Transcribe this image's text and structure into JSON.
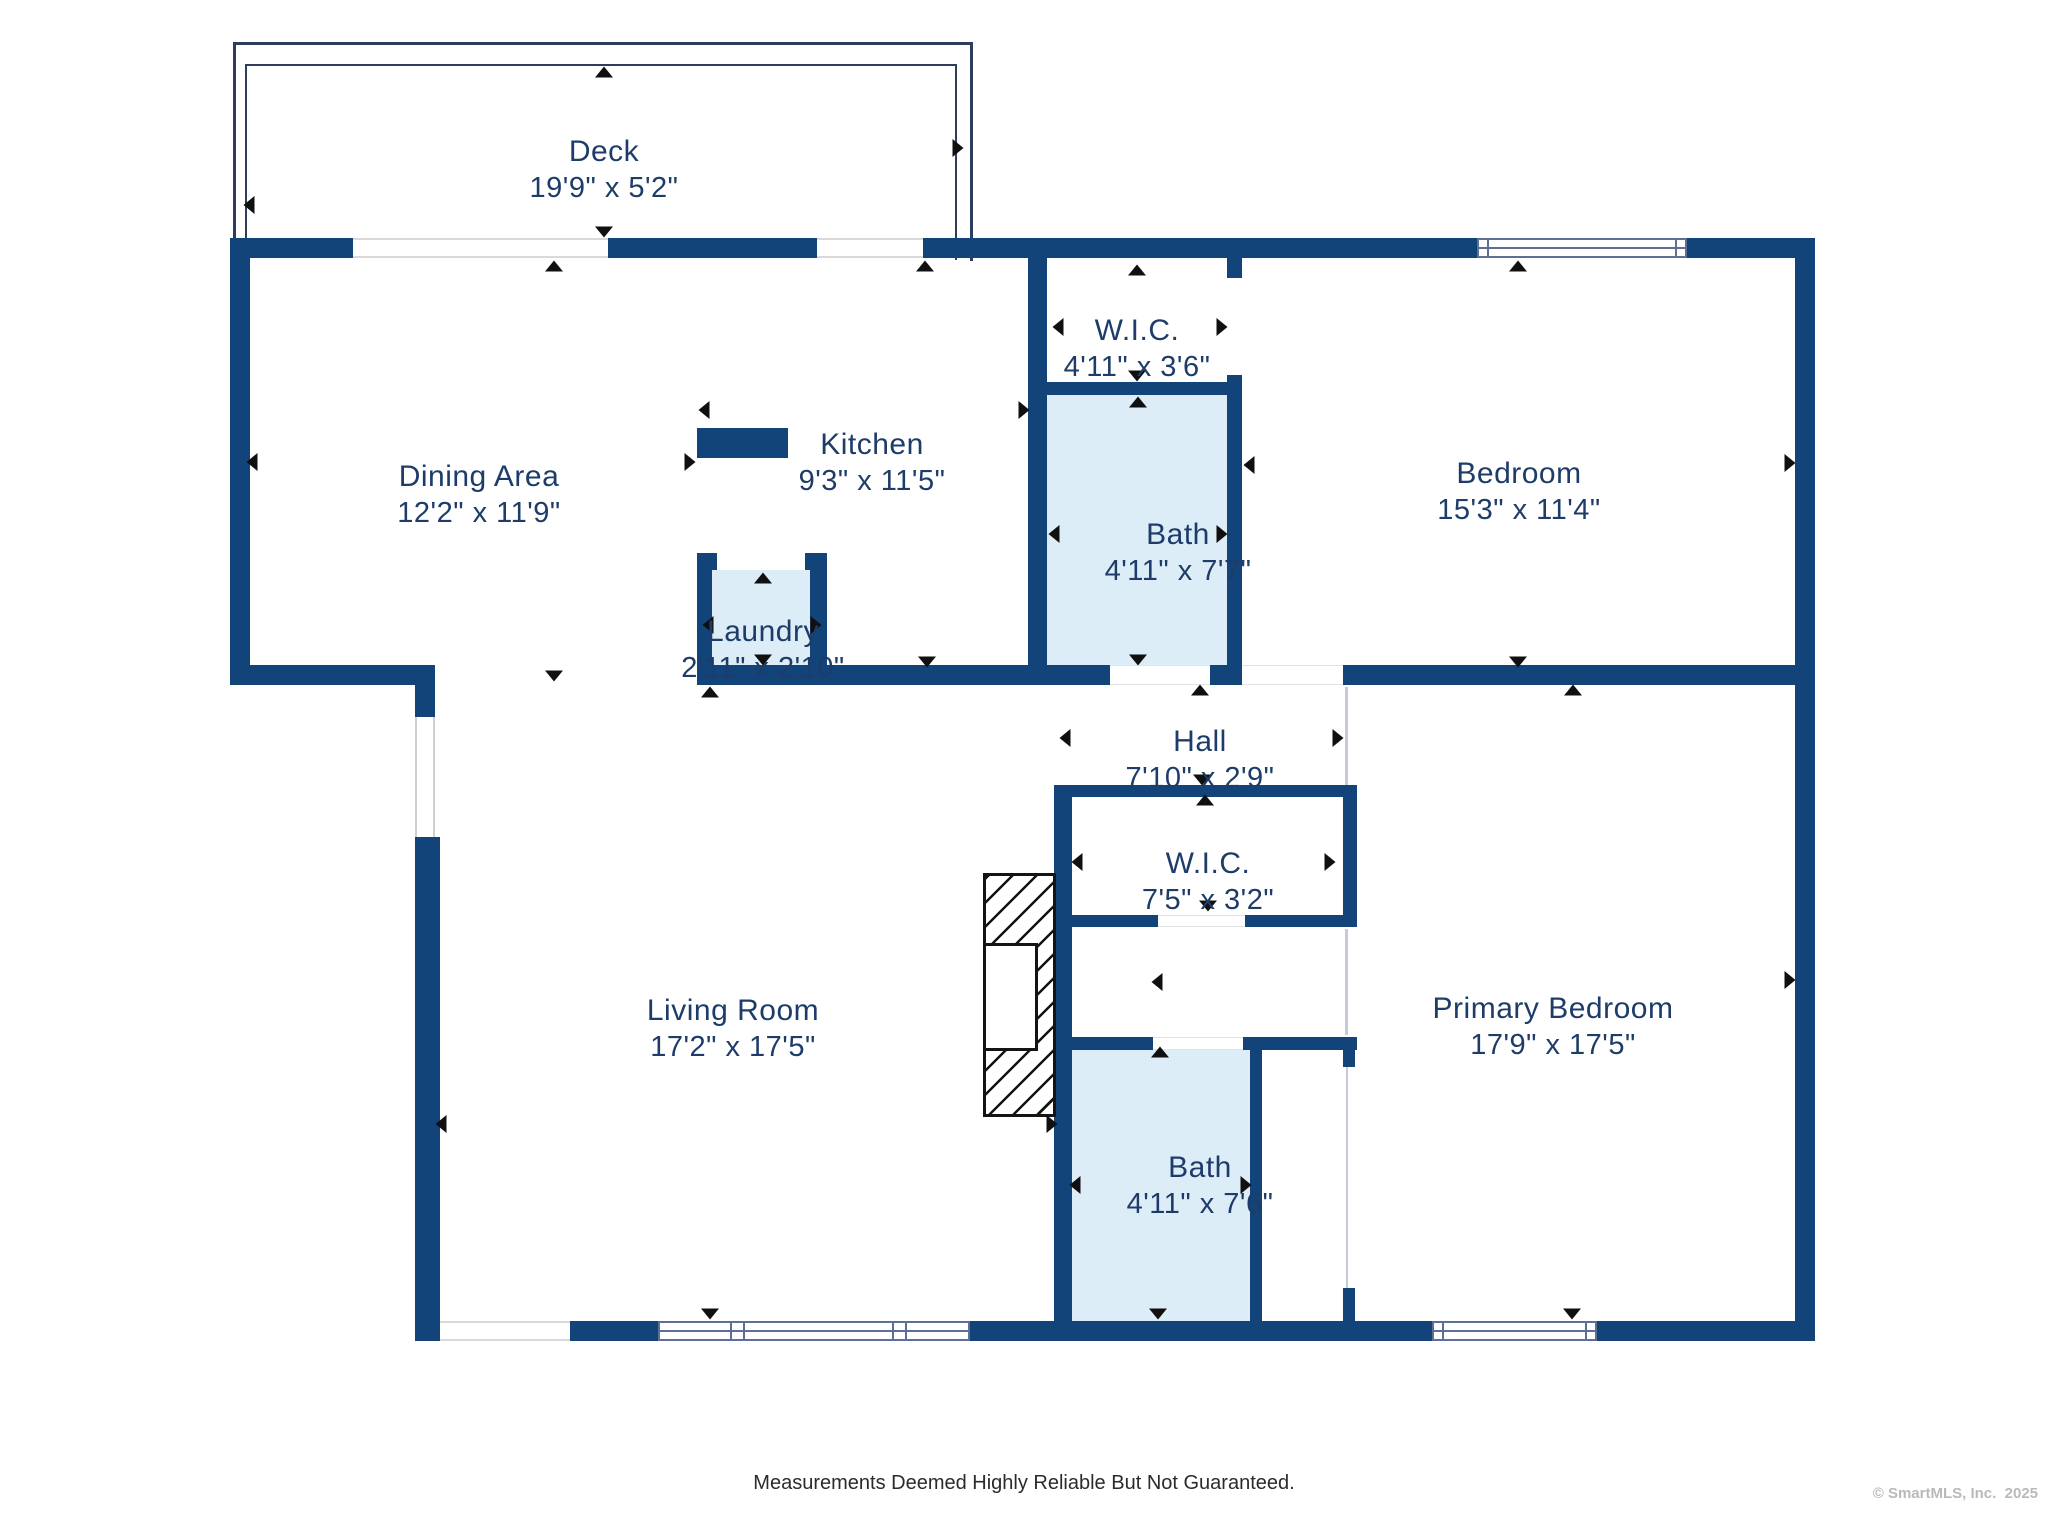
{
  "title": "Floor Plan",
  "colors": {
    "wall": "#134479",
    "room_fill": "#ffffff",
    "wet_room_fill": "#ddedf8",
    "label_text": "#1e3c69",
    "deck_outline": "#2e3d5e",
    "window_line": "#5d6f92",
    "opening_line": "#d9d9d9",
    "dimension_arrow": "#101010",
    "footer_text": "#2b2b2b",
    "copyright_text": "#b9b9b9"
  },
  "rooms": {
    "deck": {
      "name": "Deck",
      "dims": "19'9\" x 5'2\""
    },
    "dining": {
      "name": "Dining Area",
      "dims": "12'2\" x 11'9\""
    },
    "kitchen": {
      "name": "Kitchen",
      "dims": "9'3\" x 11'5\""
    },
    "laundry": {
      "name": "Laundry",
      "dims": "2'11\" x 2'10\""
    },
    "wic_top": {
      "name": "W.I.C.",
      "dims": "4'11\" x 3'6\""
    },
    "bath_top": {
      "name": "Bath",
      "dims": "4'11\" x 7'7\""
    },
    "bedroom": {
      "name": "Bedroom",
      "dims": "15'3\" x 11'4\""
    },
    "hall": {
      "name": "Hall",
      "dims": "7'10\" x 2'9\""
    },
    "wic_mid": {
      "name": "W.I.C.",
      "dims": "7'5\" x 3'2\""
    },
    "living": {
      "name": "Living Room",
      "dims": "17'2\" x 17'5\""
    },
    "primary": {
      "name": "Primary Bedroom",
      "dims": "17'9\" x 17'5\""
    },
    "bath_bottom": {
      "name": "Bath",
      "dims": "4'11\" x 7'6\""
    }
  },
  "footer": {
    "disclaimer": "Measurements Deemed Highly Reliable But Not Guaranteed.",
    "copyright": "© SmartMLS, Inc.  2025"
  }
}
